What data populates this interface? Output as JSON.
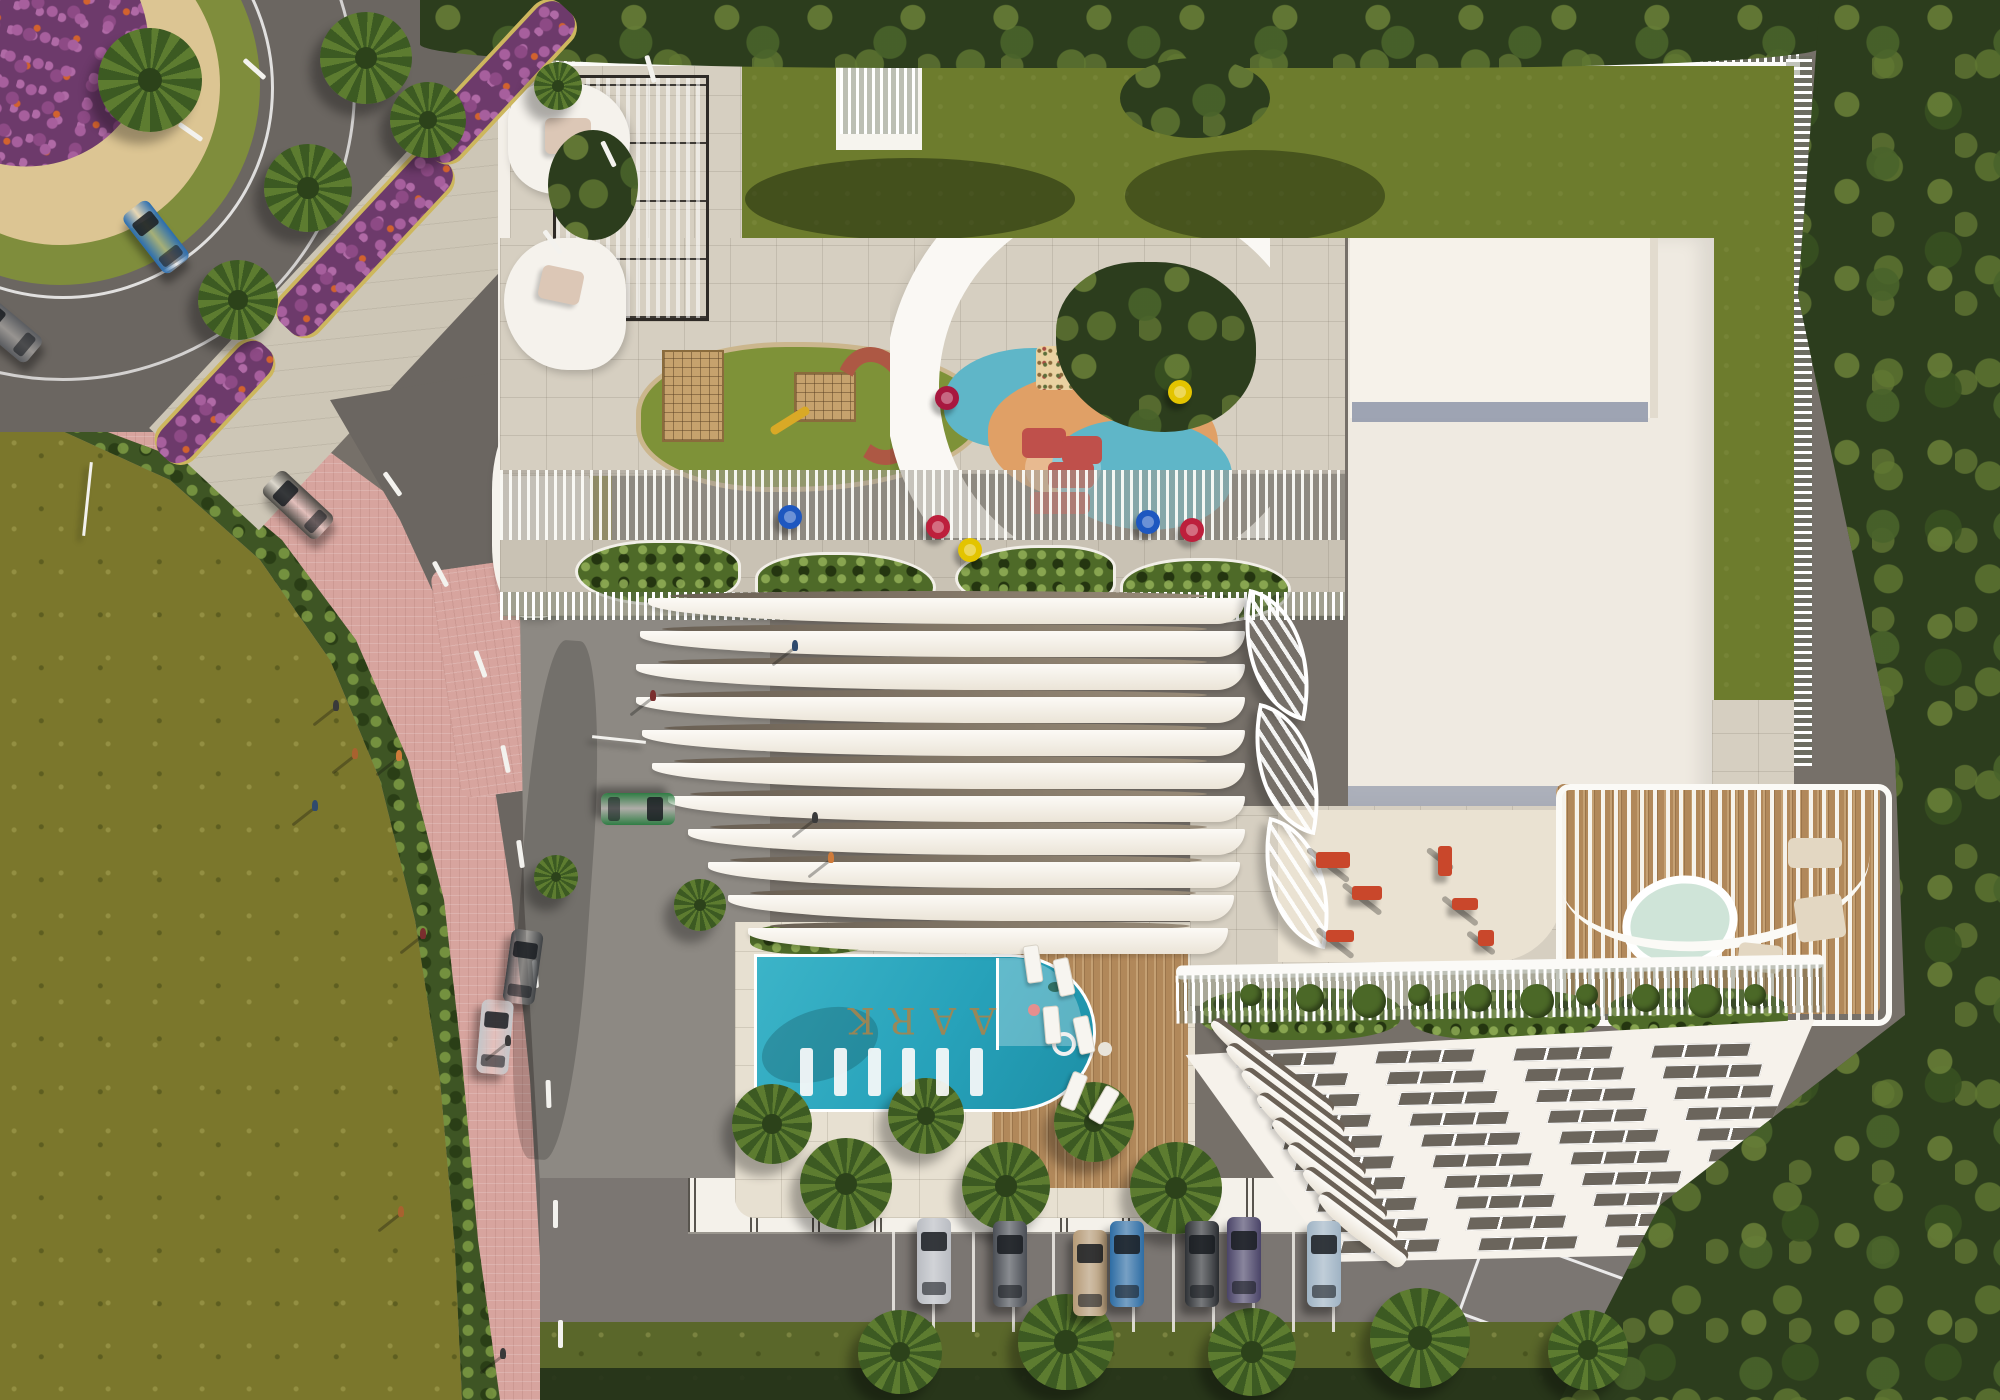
{
  "scene": {
    "pool_label": "AARK",
    "colors": {
      "asphalt": "#767069",
      "road": "#6b6661",
      "road2": "#7b7672",
      "plaza": "#8d8983",
      "pink": "#d7a49e",
      "field": "#7b772c",
      "lawn": "#6d7c2d",
      "forest": "#2c3d1d",
      "hedgec": "#3e5524",
      "paver": "#d6cfc1",
      "concrete": "#cdc6b6",
      "sand": "#dcc593",
      "grassring": "#7f8d3c",
      "slab": "#efeae1",
      "white": "#f6f3ed",
      "poolteal": "#27a2ba",
      "poolteal2": "#55c6d6",
      "gold": "#a5854f",
      "wooddeck": "#b1885a",
      "gymred": "#c9472b"
    },
    "medians": [
      {
        "x": 365,
        "y": 240,
        "len": 230,
        "w": 46,
        "rot": -47
      },
      {
        "x": 498,
        "y": 78,
        "len": 200,
        "w": 44,
        "rot": -47
      },
      {
        "x": 215,
        "y": 398,
        "len": 150,
        "w": 40,
        "rot": -47
      }
    ],
    "palms": [
      {
        "x": 150,
        "y": 80,
        "r": 52
      },
      {
        "x": 366,
        "y": 58,
        "r": 46
      },
      {
        "x": 308,
        "y": 188,
        "r": 44
      },
      {
        "x": 238,
        "y": 300,
        "r": 40
      },
      {
        "x": 428,
        "y": 120,
        "r": 38
      },
      {
        "x": 558,
        "y": 86,
        "r": 24
      },
      {
        "x": 700,
        "y": 905,
        "r": 26
      },
      {
        "x": 556,
        "y": 877,
        "r": 22
      },
      {
        "x": 772,
        "y": 1124,
        "r": 40
      },
      {
        "x": 846,
        "y": 1184,
        "r": 46
      },
      {
        "x": 926,
        "y": 1116,
        "r": 38
      },
      {
        "x": 1006,
        "y": 1186,
        "r": 44
      },
      {
        "x": 1094,
        "y": 1122,
        "r": 40
      },
      {
        "x": 1176,
        "y": 1188,
        "r": 46
      },
      {
        "x": 900,
        "y": 1352,
        "r": 42
      },
      {
        "x": 1066,
        "y": 1342,
        "r": 48
      },
      {
        "x": 1252,
        "y": 1352,
        "r": 44
      },
      {
        "x": 1420,
        "y": 1338,
        "r": 50
      },
      {
        "x": 1588,
        "y": 1350,
        "r": 40
      }
    ],
    "parked_cars": [
      {
        "x": 917,
        "y": 1218,
        "c": "#b9bcc2"
      },
      {
        "x": 993,
        "y": 1221,
        "c": "#4a4e55"
      },
      {
        "x": 1073,
        "y": 1230,
        "c": "#b59a76"
      },
      {
        "x": 1110,
        "y": 1221,
        "c": "#2e6da4"
      },
      {
        "x": 1185,
        "y": 1221,
        "c": "#2e3135"
      },
      {
        "x": 1227,
        "y": 1217,
        "c": "#4a4468"
      },
      {
        "x": 1307,
        "y": 1221,
        "c": "#9fb3c4"
      }
    ],
    "road_cars": [
      {
        "x": 140,
        "y": 200,
        "c": "#2a6daf",
        "rot": -38
      },
      {
        "x": -10,
        "y": 292,
        "c": "#5a5c60",
        "rot": -50
      },
      {
        "x": 282,
        "y": 468,
        "c": "#4c4a45",
        "rot": -47
      },
      {
        "x": 507,
        "y": 930,
        "c": "#3f4245",
        "rot": 8
      },
      {
        "x": 479,
        "y": 1000,
        "c": "#c4c6c9",
        "rot": 5
      },
      {
        "x": 622,
        "y": 772,
        "c": "#2f7d44",
        "rot": 90
      }
    ],
    "lane_dashes": [
      {
        "x": 390,
        "y": 470,
        "rot": -35
      },
      {
        "x": 438,
        "y": 560,
        "rot": -28
      },
      {
        "x": 478,
        "y": 650,
        "rot": -20
      },
      {
        "x": 503,
        "y": 745,
        "rot": -12
      },
      {
        "x": 518,
        "y": 840,
        "rot": -8
      },
      {
        "x": 533,
        "y": 960,
        "rot": -4
      },
      {
        "x": 546,
        "y": 1080,
        "rot": -2
      },
      {
        "x": 553,
        "y": 1200,
        "rot": 0
      },
      {
        "x": 558,
        "y": 1320,
        "rot": 0
      },
      {
        "x": 648,
        "y": 55,
        "rot": -16
      },
      {
        "x": 606,
        "y": 140,
        "rot": -26
      },
      {
        "x": 550,
        "y": 228,
        "rot": -36
      },
      {
        "x": 188,
        "y": 118,
        "rot": -55
      },
      {
        "x": 252,
        "y": 55,
        "rot": -48
      }
    ],
    "stalls": {
      "x0": 892,
      "step": 40,
      "count": 12,
      "y": 1232,
      "h": 100
    },
    "west_balconies": {
      "y0": 598,
      "step": 33,
      "lefts": [
        648,
        640,
        636,
        636,
        642,
        652,
        668,
        688,
        708,
        728,
        748
      ],
      "rights": [
        1245,
        1245,
        1245,
        1245,
        1245,
        1245,
        1245,
        1245,
        1240,
        1234,
        1228
      ]
    },
    "east_windows": {
      "rows": 10,
      "y0": 22,
      "stepY": 21,
      "x0": 72,
      "stepX": 11,
      "groups": 4,
      "groupW": 96,
      "gap": 42,
      "h": 12
    },
    "east_balcony_fan": {
      "x0": 1196,
      "y0": 1058,
      "dx": 16,
      "dy": 23,
      "count": 8,
      "w0": 150,
      "dw": -6
    },
    "egg_chairs": [
      {
        "x": 947,
        "y": 398,
        "c": "#a8183f"
      },
      {
        "x": 1180,
        "y": 392,
        "c": "#e3c400"
      },
      {
        "x": 1148,
        "y": 522,
        "c": "#1d57c0"
      },
      {
        "x": 1192,
        "y": 530,
        "c": "#bd1f3c"
      },
      {
        "x": 970,
        "y": 550,
        "c": "#e3c400"
      },
      {
        "x": 790,
        "y": 517,
        "c": "#1d57c0"
      },
      {
        "x": 938,
        "y": 527,
        "c": "#bd1f3c"
      }
    ],
    "pool_loungers": {
      "x0": 800,
      "step": 34,
      "count": 6,
      "y": 1048,
      "w": 13,
      "h": 48
    },
    "deck_loungers": [
      {
        "x": 1025,
        "y": 945,
        "rot": -8
      },
      {
        "x": 1056,
        "y": 958,
        "rot": -12
      },
      {
        "x": 1044,
        "y": 1006,
        "rot": -5
      },
      {
        "x": 1076,
        "y": 1016,
        "rot": -12
      },
      {
        "x": 1066,
        "y": 1072,
        "rot": 22
      },
      {
        "x": 1096,
        "y": 1086,
        "rot": 30
      }
    ],
    "gym_equipment": [
      {
        "x": 1316,
        "y": 852,
        "w": 34,
        "h": 16
      },
      {
        "x": 1352,
        "y": 886,
        "w": 30,
        "h": 14
      },
      {
        "x": 1438,
        "y": 846,
        "w": 14,
        "h": 30
      },
      {
        "x": 1452,
        "y": 898,
        "w": 26,
        "h": 12
      },
      {
        "x": 1478,
        "y": 930,
        "w": 16,
        "h": 16
      },
      {
        "x": 1326,
        "y": 930,
        "w": 28,
        "h": 12
      }
    ],
    "leaf_trellises": [
      {
        "x": 1236,
        "y": 596
      },
      {
        "x": 1246,
        "y": 710
      },
      {
        "x": 1256,
        "y": 824
      }
    ],
    "parapet_plants": {
      "x0": 1240,
      "step": 56,
      "count": 10,
      "y": 984
    },
    "people": [
      {
        "x": 333,
        "y": 700,
        "c": "#3a3a3a"
      },
      {
        "x": 352,
        "y": 748,
        "c": "#a8622f"
      },
      {
        "x": 396,
        "y": 750,
        "c": "#cf7b3a"
      },
      {
        "x": 312,
        "y": 800,
        "c": "#2f4a6d"
      },
      {
        "x": 420,
        "y": 928,
        "c": "#7a2e2e"
      },
      {
        "x": 505,
        "y": 1035,
        "c": "#3a3a3a"
      },
      {
        "x": 398,
        "y": 1206,
        "c": "#a8622f"
      },
      {
        "x": 500,
        "y": 1348,
        "c": "#3a3a3a"
      },
      {
        "x": 792,
        "y": 640,
        "c": "#2f4a6d"
      },
      {
        "x": 812,
        "y": 812,
        "c": "#3a3a3a"
      },
      {
        "x": 828,
        "y": 852,
        "c": "#cf7b3a"
      },
      {
        "x": 650,
        "y": 690,
        "c": "#7a2e2e"
      }
    ],
    "poles": [
      {
        "x": 86,
        "y": 462,
        "w": 3,
        "h": 74,
        "rot": 6
      },
      {
        "x": 592,
        "y": 738,
        "w": 54,
        "h": 3,
        "rot": 6
      }
    ]
  }
}
